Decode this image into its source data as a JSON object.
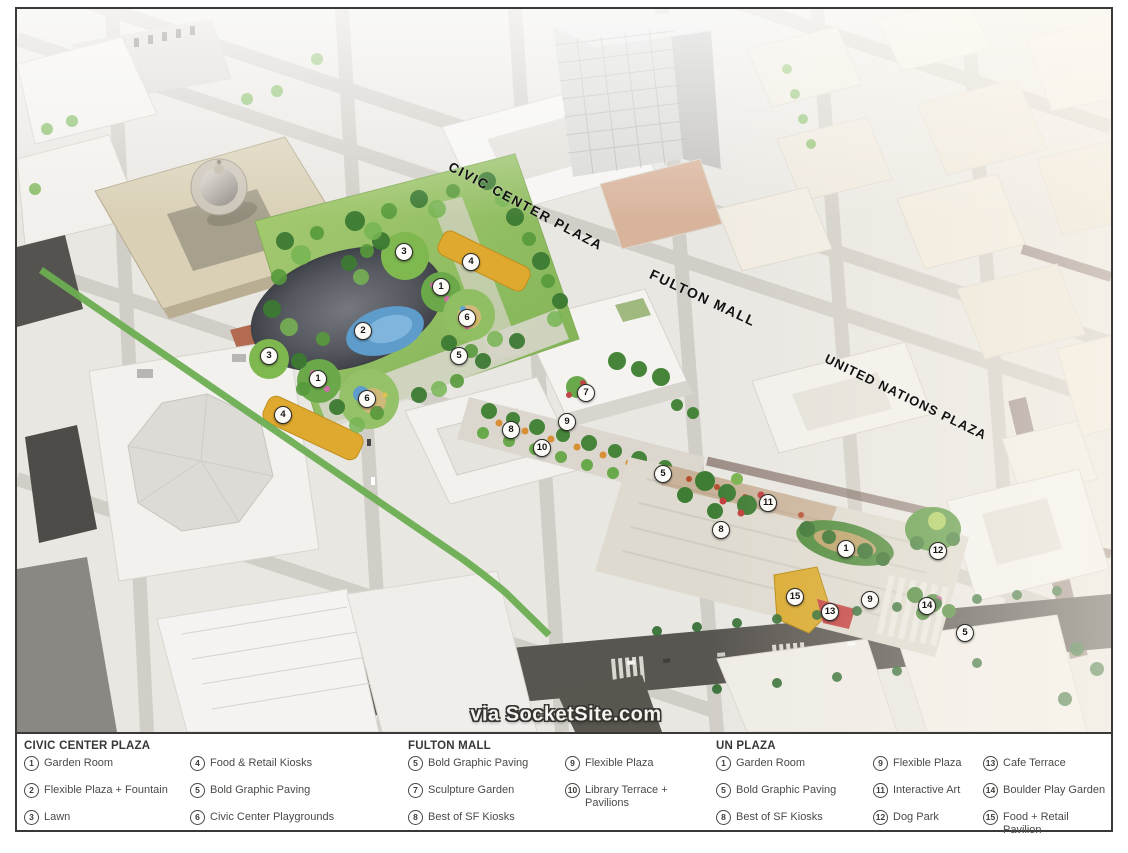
{
  "map": {
    "area_labels": [
      {
        "id": "civic-center-plaza",
        "text": "CIVIC CENTER PLAZA"
      },
      {
        "id": "fulton-mall",
        "text": "FULTON MALL"
      },
      {
        "id": "united-nations-plaza",
        "text": "UNITED NATIONS PLAZA"
      }
    ],
    "watermark": "via SocketSite.com",
    "markers": [
      {
        "n": "3",
        "x": 387,
        "y": 243,
        "area": "civic-center-plaza"
      },
      {
        "n": "4",
        "x": 454,
        "y": 253,
        "area": "civic-center-plaza"
      },
      {
        "n": "1",
        "x": 424,
        "y": 278,
        "area": "civic-center-plaza"
      },
      {
        "n": "6",
        "x": 450,
        "y": 309,
        "area": "civic-center-plaza"
      },
      {
        "n": "2",
        "x": 346,
        "y": 322,
        "area": "civic-center-plaza"
      },
      {
        "n": "5",
        "x": 442,
        "y": 347,
        "area": "civic-center-plaza"
      },
      {
        "n": "3",
        "x": 252,
        "y": 347,
        "area": "civic-center-plaza"
      },
      {
        "n": "1",
        "x": 301,
        "y": 370,
        "area": "civic-center-plaza"
      },
      {
        "n": "6",
        "x": 350,
        "y": 390,
        "area": "civic-center-plaza"
      },
      {
        "n": "4",
        "x": 266,
        "y": 406,
        "area": "civic-center-plaza"
      },
      {
        "n": "7",
        "x": 569,
        "y": 384,
        "area": "fulton-mall"
      },
      {
        "n": "9",
        "x": 550,
        "y": 413,
        "area": "fulton-mall"
      },
      {
        "n": "8",
        "x": 494,
        "y": 421,
        "area": "fulton-mall"
      },
      {
        "n": "10",
        "x": 525,
        "y": 439,
        "area": "fulton-mall"
      },
      {
        "n": "5",
        "x": 646,
        "y": 465,
        "area": "fulton-mall"
      },
      {
        "n": "11",
        "x": 751,
        "y": 494,
        "area": "un-plaza"
      },
      {
        "n": "8",
        "x": 704,
        "y": 521,
        "area": "un-plaza"
      },
      {
        "n": "1",
        "x": 829,
        "y": 540,
        "area": "un-plaza"
      },
      {
        "n": "12",
        "x": 921,
        "y": 542,
        "area": "un-plaza"
      },
      {
        "n": "15",
        "x": 778,
        "y": 588,
        "area": "un-plaza"
      },
      {
        "n": "9",
        "x": 853,
        "y": 591,
        "area": "un-plaza"
      },
      {
        "n": "13",
        "x": 813,
        "y": 603,
        "area": "un-plaza"
      },
      {
        "n": "14",
        "x": 910,
        "y": 597,
        "area": "un-plaza"
      },
      {
        "n": "5",
        "x": 948,
        "y": 624,
        "area": "un-plaza"
      }
    ]
  },
  "legend": {
    "sections": [
      {
        "title": "CIVIC CENTER PLAZA",
        "columns": [
          [
            {
              "n": "1",
              "label": "Garden Room"
            },
            {
              "n": "2",
              "label": "Flexible Plaza + Fountain"
            },
            {
              "n": "3",
              "label": "Lawn"
            }
          ],
          [
            {
              "n": "4",
              "label": "Food & Retail Kiosks"
            },
            {
              "n": "5",
              "label": "Bold Graphic Paving"
            },
            {
              "n": "6",
              "label": "Civic Center Playgrounds"
            }
          ]
        ]
      },
      {
        "title": "FULTON MALL",
        "columns": [
          [
            {
              "n": "5",
              "label": "Bold Graphic Paving"
            },
            {
              "n": "7",
              "label": "Sculpture Garden"
            },
            {
              "n": "8",
              "label": "Best of SF Kiosks"
            }
          ],
          [
            {
              "n": "9",
              "label": "Flexible Plaza"
            },
            {
              "n": "10",
              "label": "Library Terrace + Pavilions",
              "wrap": true
            }
          ]
        ]
      },
      {
        "title": "UN PLAZA",
        "columns": [
          [
            {
              "n": "1",
              "label": "Garden Room"
            },
            {
              "n": "5",
              "label": "Bold Graphic Paving"
            },
            {
              "n": "8",
              "label": "Best of SF Kiosks"
            }
          ],
          [
            {
              "n": "9",
              "label": "Flexible Plaza"
            },
            {
              "n": "11",
              "label": "Interactive Art"
            },
            {
              "n": "12",
              "label": "Dog Park"
            }
          ],
          [
            {
              "n": "13",
              "label": "Cafe Terrace"
            },
            {
              "n": "14",
              "label": "Boulder Play Garden"
            },
            {
              "n": "15",
              "label": "Food + Retail Pavilion",
              "wrap": true
            }
          ]
        ]
      }
    ]
  },
  "colors": {
    "frame_border": "#3a3938",
    "bike_lane_green": "#6cae52",
    "kiosk_yellow": "#dfa92f",
    "park_green": "#7cb052",
    "fountain_gray": "#54575d",
    "pool_blue": "#5e9ccb",
    "legend_text": "#4c4a47"
  }
}
